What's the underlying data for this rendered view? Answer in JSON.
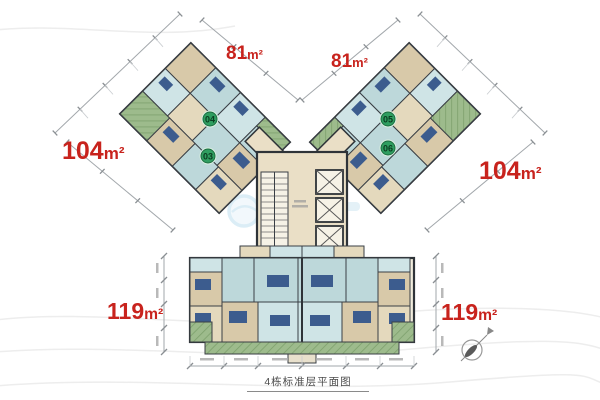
{
  "plan": {
    "caption": "4栋标准层平面图",
    "area_labels": [
      {
        "id": "unit-81-left",
        "value": "81",
        "unit": "m²"
      },
      {
        "id": "unit-81-right",
        "value": "81",
        "unit": "m²"
      },
      {
        "id": "unit-104-left",
        "value": "104",
        "unit": "m²"
      },
      {
        "id": "unit-104-right",
        "value": "104",
        "unit": "m²"
      },
      {
        "id": "unit-119-left",
        "value": "119",
        "unit": "m²"
      },
      {
        "id": "unit-119-right",
        "value": "119",
        "unit": "m²"
      }
    ],
    "unit_badges": [
      {
        "number": "04"
      },
      {
        "number": "03"
      },
      {
        "number": "05"
      },
      {
        "number": "06"
      }
    ],
    "icons": {
      "compass": "north-arrow-compass"
    },
    "colors": {
      "area_label_red": "#c8231d",
      "badge_green": "#2f9e60",
      "room_blue": "#bdd8da",
      "room_tan": "#d8c9a9",
      "balcony_green": "#9dbb8c",
      "wall_dark": "#2e3338",
      "dimension_gray": "#a2a7ab",
      "watermark_blue": "#bfe0ef"
    }
  }
}
